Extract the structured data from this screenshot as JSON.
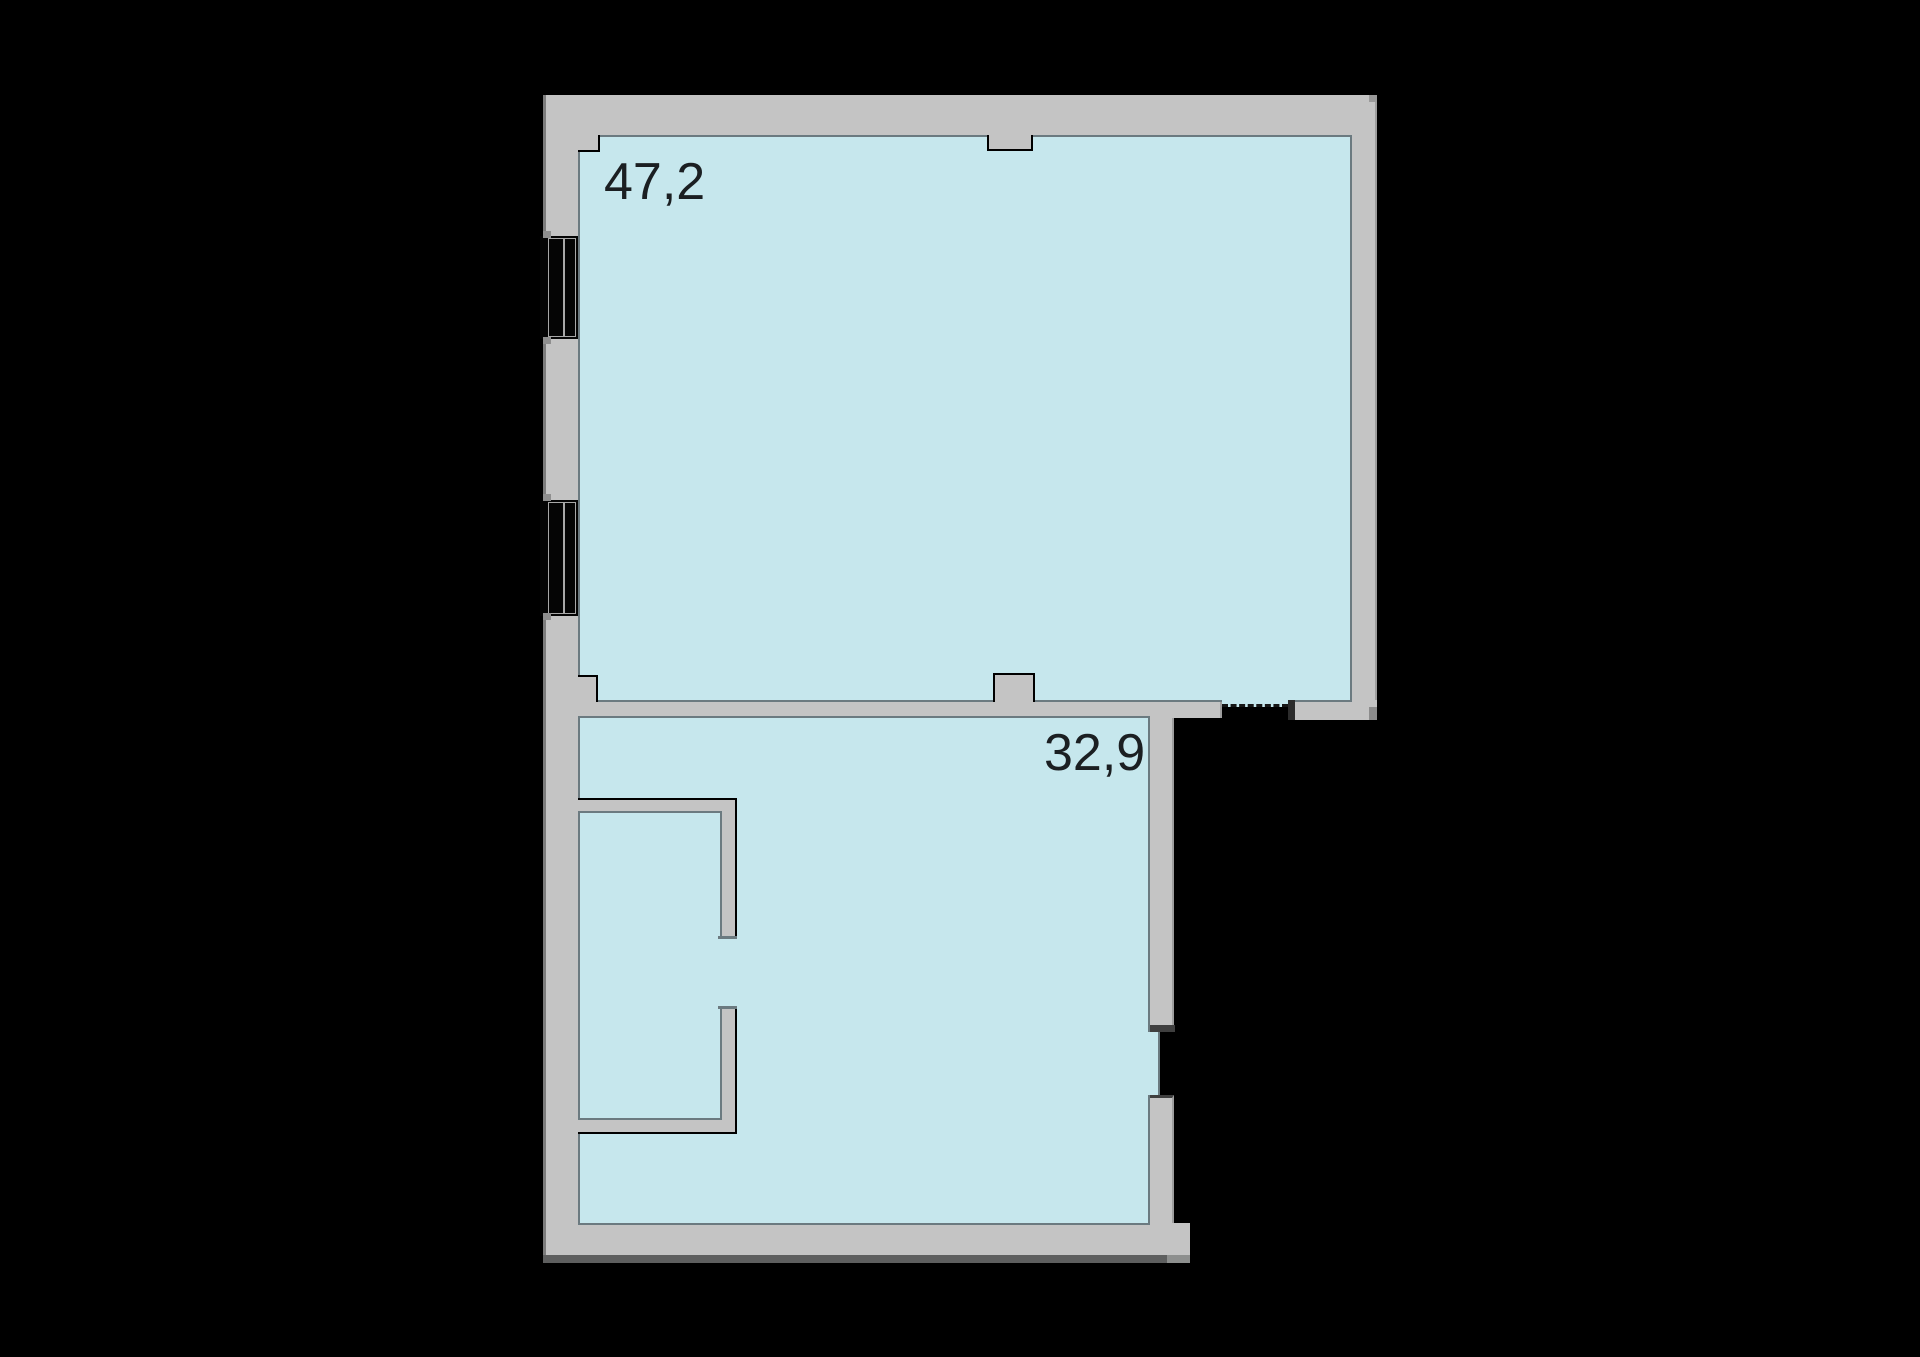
{
  "title": "apartment floor plan",
  "palette": {
    "background": "#000000",
    "wall": "#c4c4c4",
    "floor": "#c6e7ed",
    "outline": "#6b7a80",
    "outer_line": "#7c7c7c",
    "edge_light": "#9e9e9e",
    "shadow_dark": "#5e5f5f",
    "shadow_light": "#8d8f8e",
    "cap_gray": "#8f8f8f",
    "cap_dark": "#3f3f3f",
    "jamb_dark": "#2c2c2c",
    "frame_light": "#a8a8a8",
    "text": "#1b1f22"
  },
  "rooms": [
    {
      "id": "upper",
      "area_label": "47,2"
    },
    {
      "id": "lower",
      "area_label": "32,9"
    }
  ],
  "features": {
    "windows": [
      "window-1",
      "window-2"
    ],
    "openings": [
      "divider-dashed-opening",
      "lower-room-right-opening"
    ]
  }
}
